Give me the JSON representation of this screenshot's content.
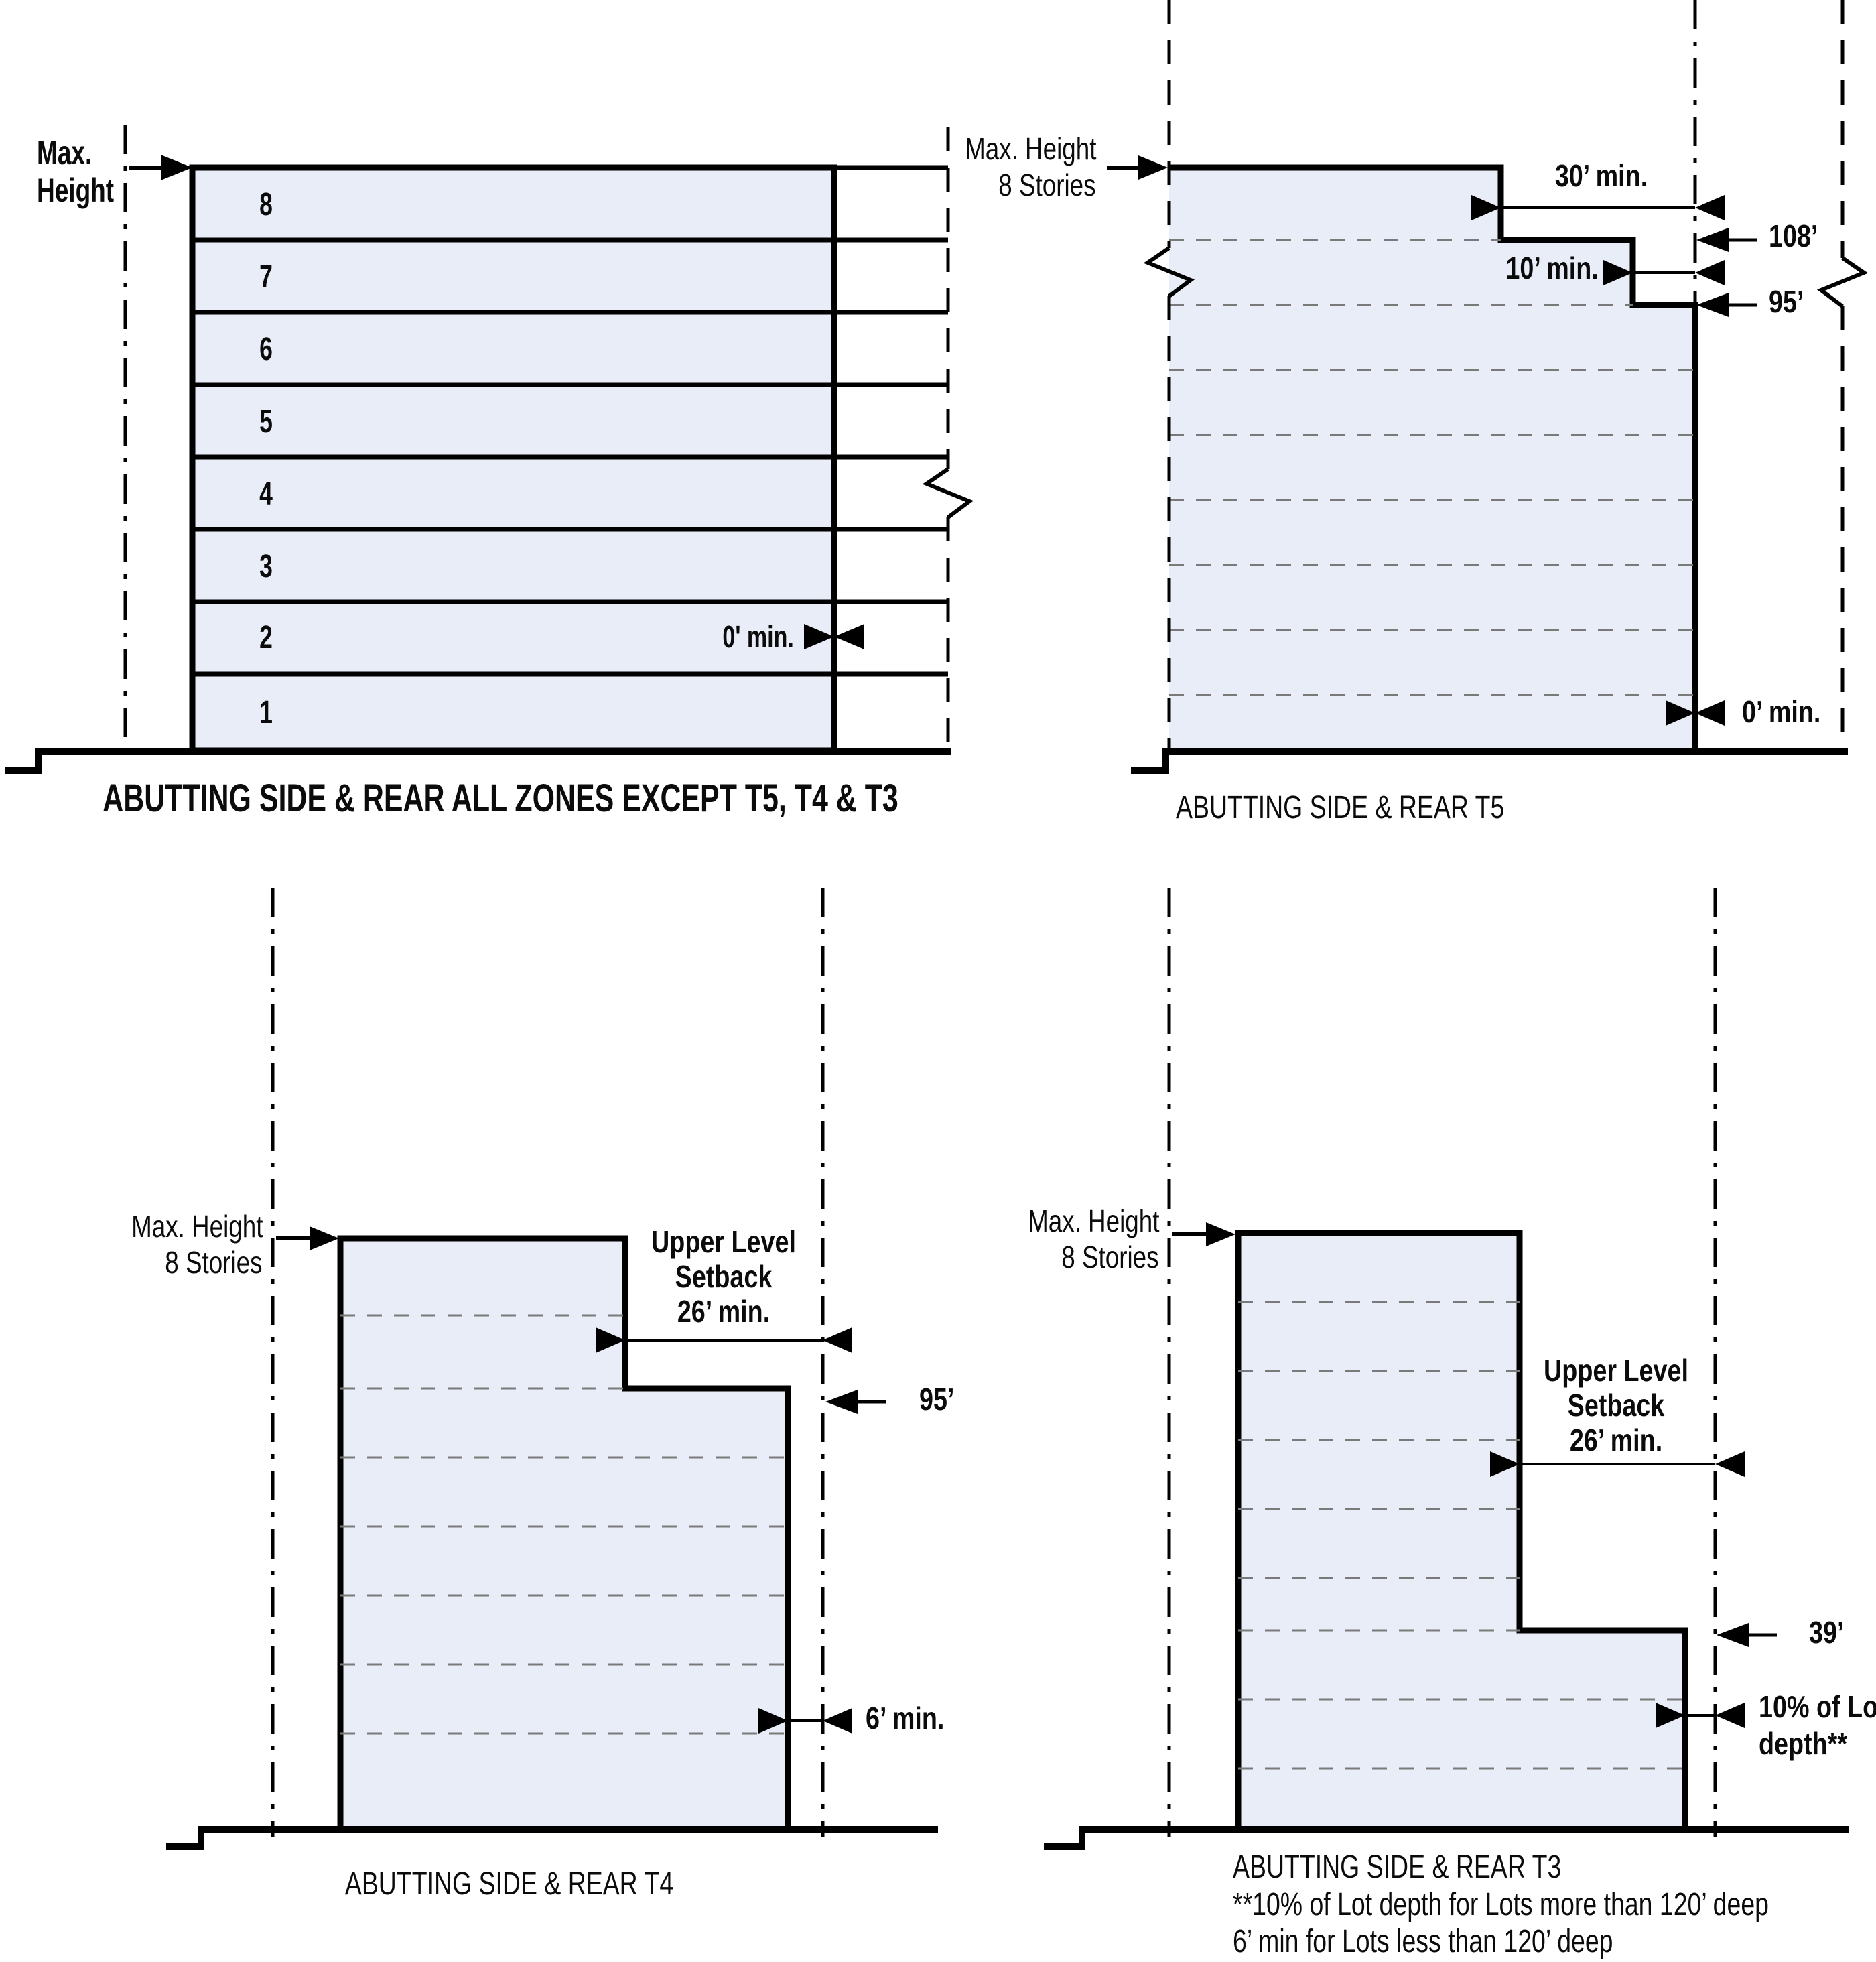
{
  "colors": {
    "background": "#ffffff",
    "building_fill": "#e8edf8",
    "line": "#000000",
    "floor_dash": "#7a7a7a"
  },
  "all_zones": {
    "title": "ABUTTING SIDE & REAR ALL ZONES EXCEPT T5, T4 & T3",
    "max_height_line1": "Max.",
    "max_height_line2": "Height",
    "floors": [
      "8",
      "7",
      "6",
      "5",
      "4",
      "3",
      "2",
      "1"
    ],
    "side_setback": "0' min."
  },
  "t5": {
    "title": "ABUTTING SIDE & REAR T5",
    "max_height_line1": "Max. Height",
    "max_height_line2": "8 Stories",
    "upper_setback": "30’ min.",
    "upper_height": "108’",
    "mid_setback": "10’ min.",
    "mid_height": "95’",
    "ground_setback": "0’ min."
  },
  "t4": {
    "title": "ABUTTING SIDE & REAR T4",
    "max_height_line1": "Max. Height",
    "max_height_line2": "8 Stories",
    "upper_setback_line1": "Upper Level",
    "upper_setback_line2": "Setback",
    "upper_setback_line3": "26’ min.",
    "step_height": "95’",
    "ground_setback": "6’ min."
  },
  "t3": {
    "title": "ABUTTING SIDE & REAR T3",
    "max_height_line1": "Max. Height",
    "max_height_line2": "8 Stories",
    "upper_setback_line1": "Upper Level",
    "upper_setback_line2": "Setback",
    "upper_setback_line3": "26’ min.",
    "step_height": "39’",
    "ground_setback_line1": "10% of Lot",
    "ground_setback_line2": "depth**",
    "footnote_line1": "**10% of Lot depth for Lots more than 120’ deep",
    "footnote_line2": "6’ min for Lots less than 120’ deep"
  }
}
